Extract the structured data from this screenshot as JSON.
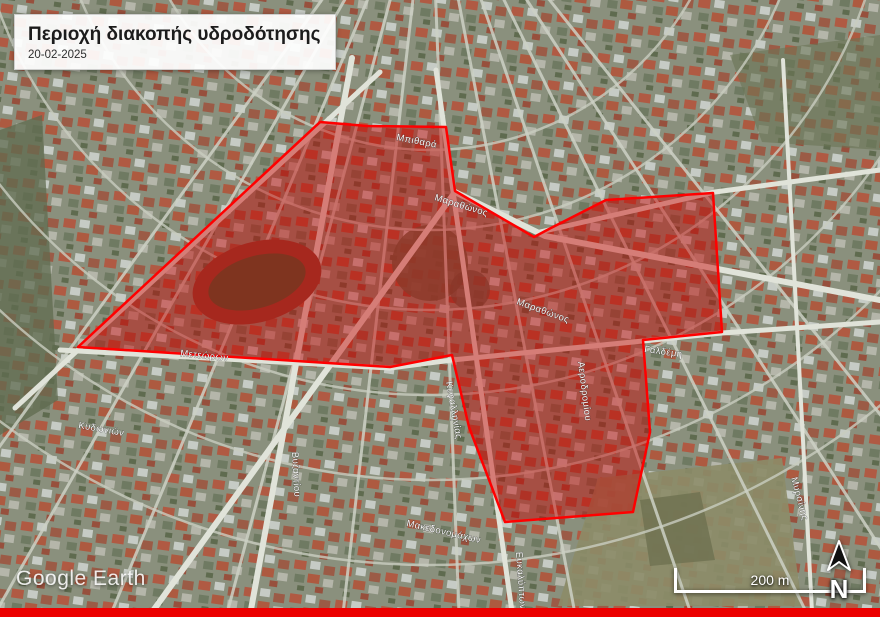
{
  "header": {
    "title": "Περιοχή διακοπής υδροδότησης",
    "date": "20-02-2025"
  },
  "map": {
    "watermark": "Google Earth",
    "scale_bar": {
      "label": "200 m"
    },
    "north": {
      "label": "N"
    },
    "overlay": {
      "description": "water-outage-area-polygon",
      "fill": "#c80000",
      "stroke": "#ff0000"
    },
    "street_labels": [
      {
        "name": "Μετεώρων"
      },
      {
        "name": "Κυδωνιών"
      },
      {
        "name": "Μαραθώνος"
      },
      {
        "name": "Γαλδέμη"
      },
      {
        "name": "Αεροδρομίου"
      },
      {
        "name": "Κεφαλληνίας"
      },
      {
        "name": "Μακεδονομάχων"
      },
      {
        "name": "Ευκαλύπτων"
      },
      {
        "name": "Μυρσίνης"
      },
      {
        "name": "Βυζαντίου"
      },
      {
        "name": "Μαραθώνος"
      },
      {
        "name": "Μπιθαρά"
      }
    ],
    "icons": {
      "north_arrow": "north-arrow-icon"
    },
    "colors": {
      "bottom_bar": "#ec0000",
      "overlay_fill": "#c80000",
      "overlay_stroke": "#ff0000"
    }
  }
}
